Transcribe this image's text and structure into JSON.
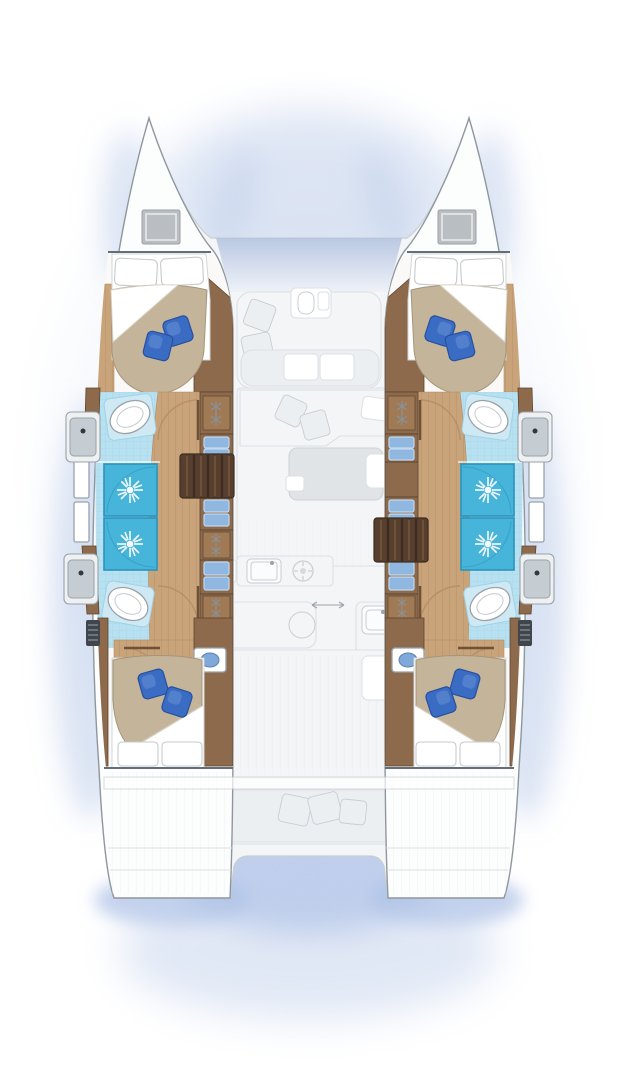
{
  "image": {
    "width": 618,
    "height": 1080,
    "description": "catamaran yacht floor plan, top-down, four cabins"
  },
  "palette": {
    "page_bg": "#ffffff",
    "halo": "#dde6f3",
    "shadow_blue": "#bdcdea",
    "shadow_blue_deep": "#a6bce4",
    "ghost_fill": "#f3f5f7",
    "ghost_fill_2": "#eceff2",
    "ghost_line": "#dbe0e4",
    "ghost_dark": "#c8ced3",
    "hull_white": "#fcfdfd",
    "hull_line": "#8f979e",
    "strong_line": "#646e76",
    "interior_base": "#faf9f7",
    "wood": "#8d6a4c",
    "wood_dark": "#6e5238",
    "wood_edge": "#5d452f",
    "stair_dark": "#573f2f",
    "stair_tread": "#6f5138",
    "stair_gap": "#3e2c1f",
    "floor_wood": "#c9a379",
    "floor_line": "#b28b63",
    "door_wood": "#b5906a",
    "tile": "#b7e0f0",
    "tile_line": "#9fd2e6",
    "shower": "#47b4da",
    "shower_line": "#2a93bd",
    "fixture": "#c6cdd2",
    "fixture_line": "#99a2a9",
    "fixture_dark": "#33383d",
    "sink_top": "#eef0f1",
    "pedestal": "#cfe9f4",
    "duvet": "#c4b49a",
    "duvet_line": "#a4957c",
    "sheet_line": "#d3d6d9",
    "fold_line": "#d8d2c6",
    "pillow": "#3a6cc3",
    "pillow_dark": "#27509e",
    "pillow_light": "#7499d6",
    "drawer_blue": "#8fb7e0",
    "drawer_blue_light": "#c2d8ee",
    "hanger_back": "#a07a54",
    "hanger_metal": "#8a9198",
    "hatch": "#b9bec2",
    "vent": "#40464c",
    "bowl_blue": "#7fa9d9",
    "bowl_edge": "#5b82b5",
    "table_ghost": "#e0e4e7",
    "deck_gradient_top": "#b3c3e0",
    "deck_gradient_bottom": "#eef2f8",
    "white": "#ffffff"
  },
  "plan": {
    "hulls": [
      {
        "id": "port",
        "cabins": [
          "forward-double-cabin",
          "aft-double-cabin"
        ],
        "bathroom": {
          "toilets": 2,
          "sinks": 2,
          "showers": 2
        },
        "wardrobes": 3,
        "drawer_units": 4,
        "windows": 2,
        "stairs": "companionway"
      },
      {
        "id": "starboard",
        "cabins": [
          "forward-double-cabin",
          "aft-double-cabin"
        ],
        "bathroom": {
          "toilets": 2,
          "sinks": 2,
          "showers": 2
        },
        "wardrobes": 3,
        "drawer_units": 4,
        "windows": 2,
        "stairs": "companionway"
      }
    ],
    "center_ghost_deck": [
      "forward-deck",
      "forward-cockpit-lounge",
      "salon-sofa",
      "salon-table",
      "galley-counters",
      "island-unit",
      "aft-cockpit",
      "aft-bench",
      "transom-platforms"
    ],
    "decor": {
      "blue_pillows_per_bed": 2,
      "white_pillows_per_bed": 2
    }
  }
}
